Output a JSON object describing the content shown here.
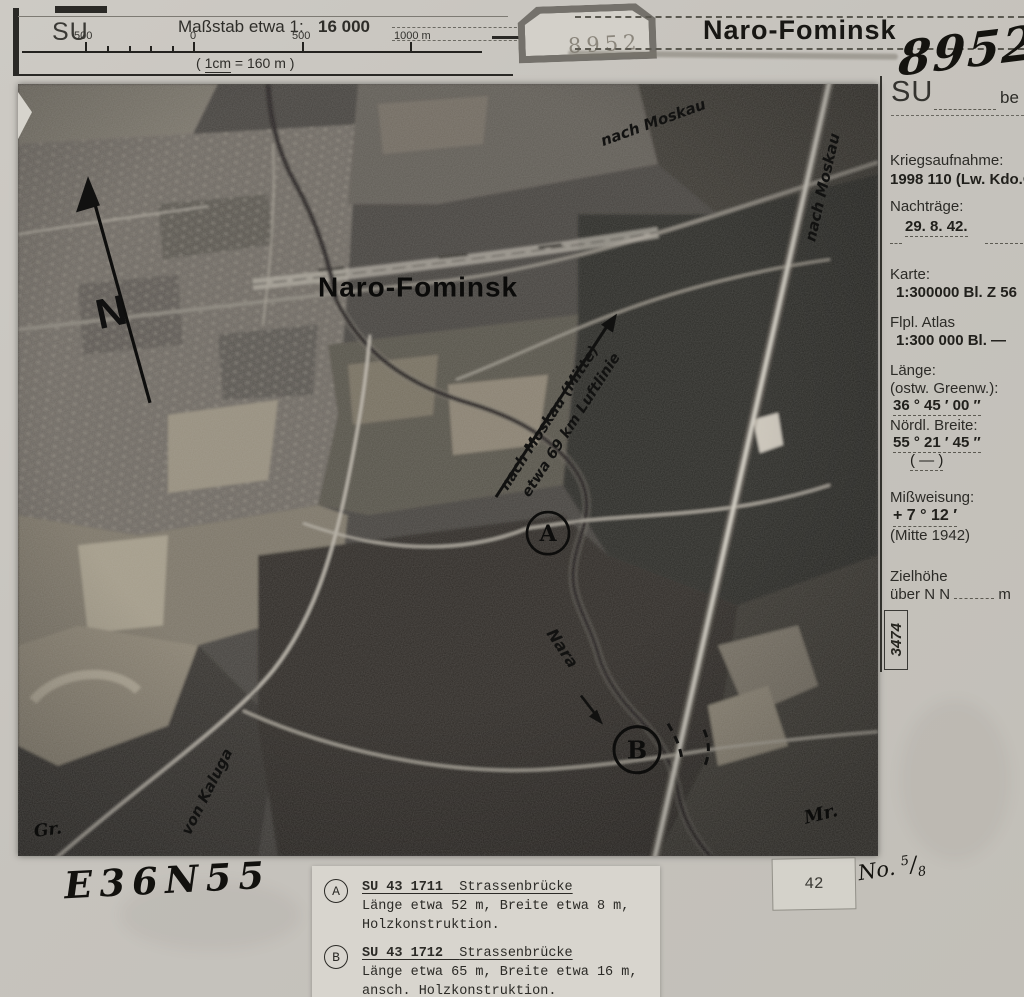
{
  "palette": {
    "paper": "#c8c5bf",
    "ink": "#26251F",
    "photo_dark": "#2e2b27",
    "photo_mid": "#5d5951",
    "stamp_gray": "#8a857c",
    "annotation_ink": "#111110"
  },
  "header": {
    "su": "SU",
    "massstab_label": "Maßstab etwa 1:",
    "massstab_value": "16 000",
    "scale_ticks": [
      "500",
      "0",
      "500",
      "1000 m"
    ],
    "note_pre": "(",
    "note_cm": "1cm",
    "note_rest": "= 160 m )",
    "stamp_number": "8952",
    "title": "Naro-Fominsk"
  },
  "margin": {
    "photo_number": "8952",
    "su": "SU",
    "su_suffix": "be",
    "kriegsaufnahme_label": "Kriegsaufnahme:",
    "kriegsaufnahme_value": "1998 110 (Lw. Kdo.O",
    "nachtraege_label": "Nachträge:",
    "nachtraege_value": "29. 8. 42.",
    "karte_label": "Karte:",
    "karte_value": "1:300000 Bl. Z 56",
    "flpl_label": "Flpl. Atlas",
    "flpl_value": "1:300 000 Bl. —",
    "laenge_label": "Länge:",
    "laenge_sub": "(ostw. Greenw.):",
    "laenge_value": "36 ° 45 ′ 00 ″",
    "breite_label": "Nördl. Breite:",
    "breite_value": "55 ° 21 ′ 45 ″",
    "breite_blank": "(      —      )",
    "missweisung_label": "Mißweisung:",
    "missweisung_value": "+ 7 ° 12 ′",
    "missweisung_sub": "(Mitte 1942)",
    "zielhoehe_label": "Zielhöhe",
    "zielhoehe_prefix": "über N N",
    "zielhoehe_unit": "m",
    "registry_number": "3474"
  },
  "photo": {
    "title": "Naro-Fominsk",
    "north": "N",
    "moskau_mitte_1": "nach Moskau (Mitte)",
    "moskau_mitte_2": "etwa 69 km Luftlinie",
    "moskau_top": "nach Moskau",
    "moskau_right": "nach Moskau",
    "kaluga": "von Kaluga",
    "river": "Nara",
    "marker_a": "A",
    "marker_b": "B",
    "sig_left": "Gr.",
    "sig_right": "Mr."
  },
  "footer": {
    "grid_ref": "E36N55",
    "stamp_42": "42",
    "no_label": "No.",
    "no_num": "5",
    "no_den": "8",
    "notes": [
      {
        "marker": "A",
        "id": "SU 43 1711",
        "type": "Strassenbrücke",
        "dims": "Länge etwa 52 m, Breite etwa 8 m,",
        "extra": "Holzkonstruktion."
      },
      {
        "marker": "B",
        "id": "SU 43 1712",
        "type": "Strassenbrücke",
        "dims": "Länge etwa 65 m, Breite etwa 16 m,",
        "extra": "ansch. Holzkonstruktion."
      }
    ]
  }
}
